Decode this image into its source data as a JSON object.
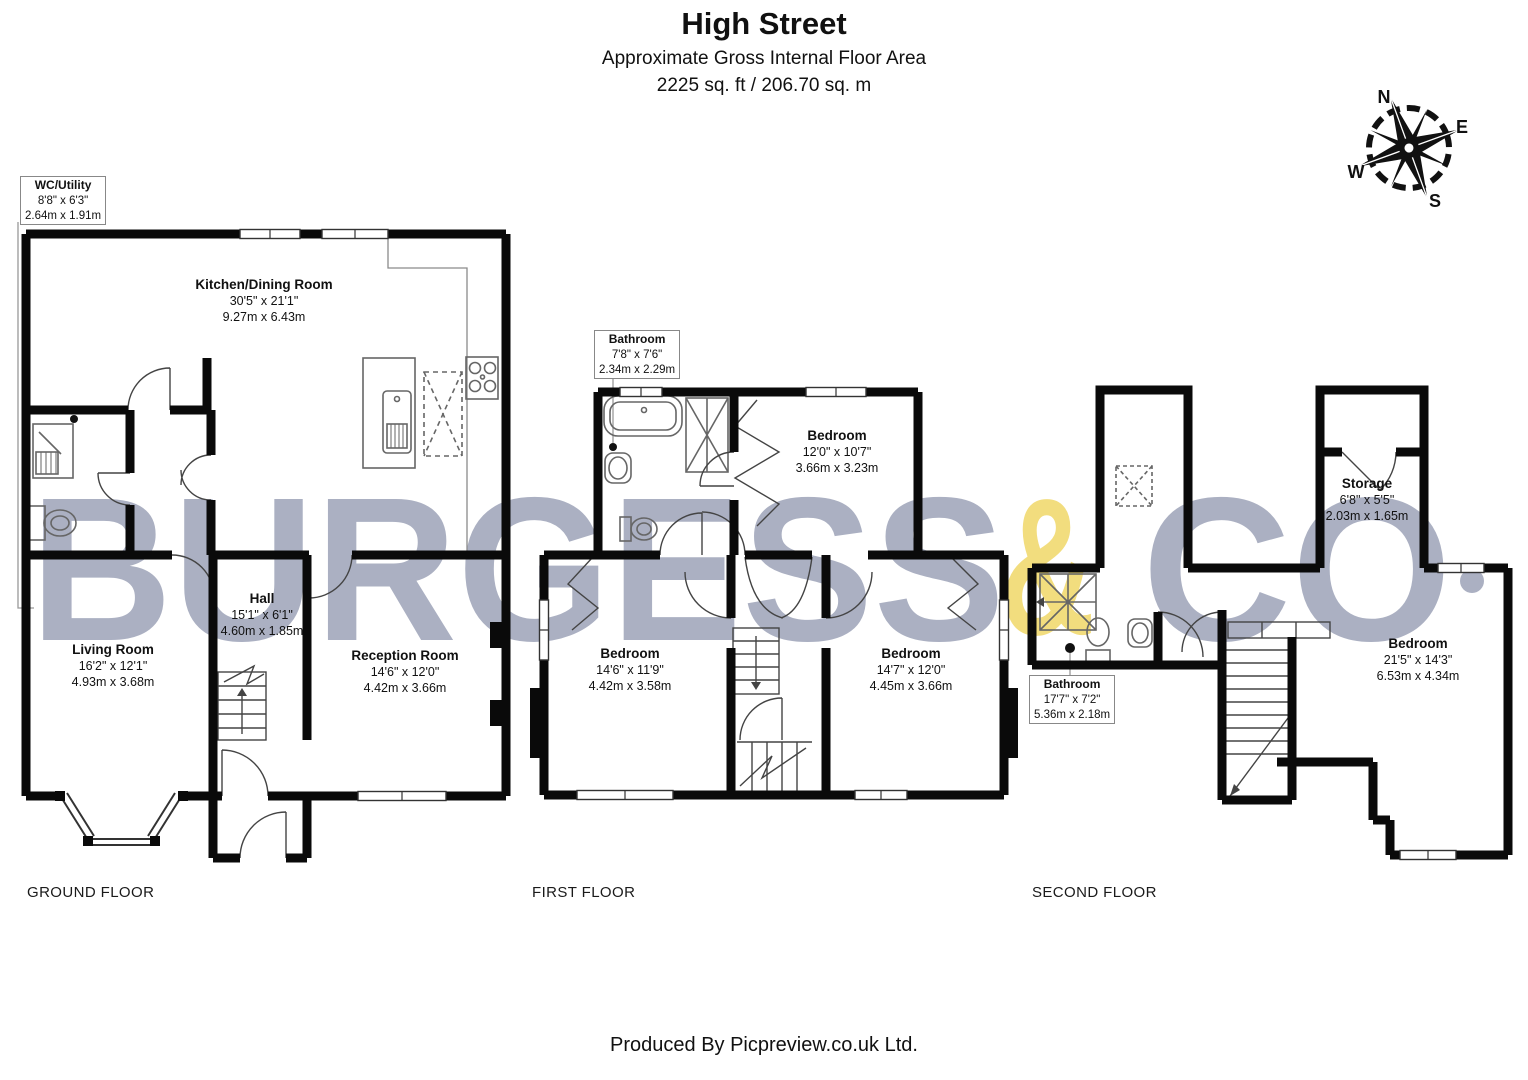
{
  "header": {
    "title": "High Street",
    "subtitle": "Approximate Gross Internal Floor Area",
    "area": "2225 sq. ft / 206.70 sq. m"
  },
  "compass": {
    "n": "N",
    "e": "E",
    "s": "S",
    "w": "W"
  },
  "watermark": {
    "full_text": "BURGESS & CO.",
    "part1": "BURGESS",
    "amp": "&",
    "part2": "CO",
    "gray": "#abb0c2",
    "yellow": "#f2dd7e"
  },
  "floors": [
    {
      "caption": "GROUND FLOOR",
      "rooms": [
        {
          "name": "WC/Utility",
          "imperial": "8'8\" x 6'3\"",
          "metric": "2.64m x 1.91m"
        },
        {
          "name": "Kitchen/Dining Room",
          "imperial": "30'5\" x 21'1\"",
          "metric": "9.27m x 6.43m"
        },
        {
          "name": "Hall",
          "imperial": "15'1\" x 6'1\"",
          "metric": "4.60m x 1.85m"
        },
        {
          "name": "Living Room",
          "imperial": "16'2\" x 12'1\"",
          "metric": "4.93m x 3.68m"
        },
        {
          "name": "Reception Room",
          "imperial": "14'6\" x 12'0\"",
          "metric": "4.42m x 3.66m"
        }
      ]
    },
    {
      "caption": "FIRST FLOOR",
      "rooms": [
        {
          "name": "Bathroom",
          "imperial": "7'8\" x 7'6\"",
          "metric": "2.34m x 2.29m"
        },
        {
          "name": "Bedroom",
          "imperial": "12'0\" x 10'7\"",
          "metric": "3.66m x 3.23m"
        },
        {
          "name": "Bedroom",
          "imperial": "14'6\" x 11'9\"",
          "metric": "4.42m x 3.58m"
        },
        {
          "name": "Bedroom",
          "imperial": "14'7\" x 12'0\"",
          "metric": "4.45m x 3.66m"
        }
      ]
    },
    {
      "caption": "SECOND FLOOR",
      "rooms": [
        {
          "name": "Storage",
          "imperial": "6'8\" x 5'5\"",
          "metric": "2.03m x 1.65m"
        },
        {
          "name": "Bathroom",
          "imperial": "17'7\" x 7'2\"",
          "metric": "5.36m x 2.18m"
        },
        {
          "name": "Bedroom",
          "imperial": "21'5\" x 14'3\"",
          "metric": "6.53m x 4.34m"
        }
      ]
    }
  ],
  "footer": {
    "credit": "Produced By Picpreview.co.uk Ltd."
  }
}
